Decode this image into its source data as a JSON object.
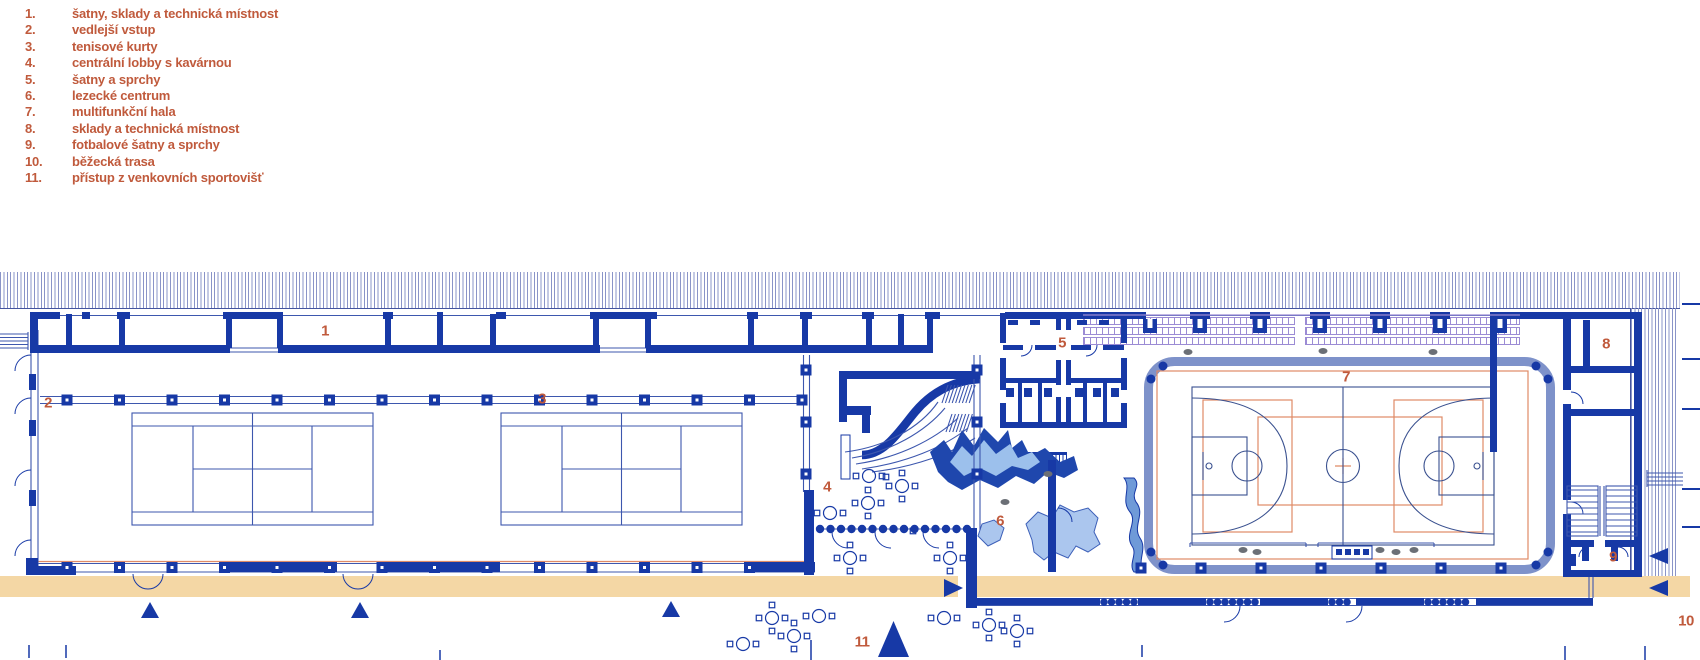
{
  "legend": {
    "items": [
      {
        "num": "1.",
        "label": "šatny, sklady a technická místnost"
      },
      {
        "num": "2.",
        "label": "vedlejší vstup"
      },
      {
        "num": "3.",
        "label": "tenisové kurty"
      },
      {
        "num": "4.",
        "label": "centrální lobby s kavárnou"
      },
      {
        "num": "5.",
        "label": "šatny a sprchy"
      },
      {
        "num": "6.",
        "label": "lezecké centrum"
      },
      {
        "num": "7.",
        "label": "multifunkční hala"
      },
      {
        "num": "8.",
        "label": "sklady a technická místnost"
      },
      {
        "num": "9.",
        "label": "fotbalové šatny a sprchy"
      },
      {
        "num": "10.",
        "label": "běžecká trasa"
      },
      {
        "num": "11.",
        "label": "přístup z venkovních sportovišť"
      }
    ]
  },
  "plan": {
    "labels": [
      {
        "id": "1",
        "x": 325,
        "y": 331
      },
      {
        "id": "2",
        "x": 48,
        "y": 403
      },
      {
        "id": "3",
        "x": 542,
        "y": 399
      },
      {
        "id": "4",
        "x": 827,
        "y": 487
      },
      {
        "id": "5",
        "x": 1062,
        "y": 343
      },
      {
        "id": "6",
        "x": 1000,
        "y": 521
      },
      {
        "id": "7",
        "x": 1346,
        "y": 377
      },
      {
        "id": "8",
        "x": 1606,
        "y": 344
      },
      {
        "id": "9",
        "x": 1613,
        "y": 557
      },
      {
        "id": "10",
        "x": 1686,
        "y": 621
      },
      {
        "id": "11",
        "x": 862,
        "y": 642
      }
    ],
    "colors": {
      "wall_navy": "#1739a6",
      "line_blue": "#3d57ae",
      "hatch_blue": "#8a94c8",
      "accent_orange": "#c05a3c",
      "court_orange": "#df8a66",
      "track_tan": "#f4d7a5",
      "hall_slate": "#7e92ca",
      "tribune_purple": "#9b8bd4",
      "figure_gray": "#6b6f76",
      "boulder_dark": "#1f47ad",
      "boulder_light": "#abc6ee",
      "boulder_mid": "#6f9ad8"
    }
  }
}
